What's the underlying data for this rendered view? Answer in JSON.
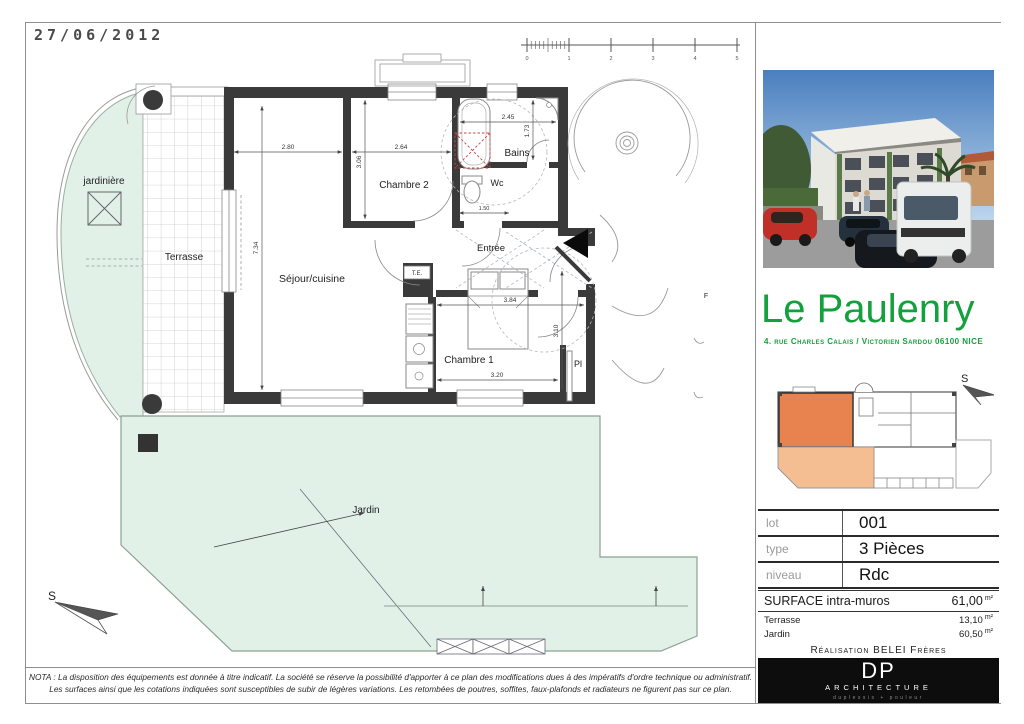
{
  "sheet": {
    "date": "27/06/2012",
    "scale_labels": [
      "0",
      "1",
      "2",
      "3",
      "4",
      "5"
    ],
    "nota_line1": "NOTA : La disposition des équipements est donnée à titre indicatif. La société se réserve la possibilité d'apporter à ce plan des modifications dues à des impératifs d'ordre technique ou administratif.",
    "nota_line2": "Les surfaces ainsi que les cotations indiquées sont susceptibles de subir de légères variations. Les retombées de poutres, soffites, faux-plafonds et radiateurs ne figurent pas sur ce plan."
  },
  "plan": {
    "labels": {
      "jardiniere": "jardinière",
      "terrasse": "Terrasse",
      "sejour": "Séjour/cuisine",
      "chambre2": "Chambre 2",
      "chambre1": "Chambre 1",
      "bains": "Bains",
      "wc": "Wc",
      "entree": "Entrée",
      "placard": "Pl",
      "jardin": "Jardin",
      "f": "F",
      "te": "T.E.",
      "compass_south": "S"
    },
    "dimensions": {
      "sejour_width": "2.80",
      "chambre2_width": "2.64",
      "chambre2_height": "3.06",
      "sejour_height": "7.34",
      "bains_width": "2.45",
      "bains_height": "1.73",
      "wc_width": "1.50",
      "chambre1_width": "3.84",
      "chambre1_height": "3.10",
      "chambre1_width_bottom": "3.20"
    }
  },
  "panel": {
    "title": "Le Paulenry",
    "address": "4. rue Charles Calais / Victorien Sardou 06100 NICE",
    "compass_south": "S",
    "info_table": {
      "rows": [
        {
          "label": "lot",
          "value": "001"
        },
        {
          "label": "type",
          "value": "3 Pièces"
        },
        {
          "label": "niveau",
          "value": "Rdc"
        }
      ]
    },
    "surfaces": {
      "main_label": "SURFACE intra-muros",
      "main_value": "61,00",
      "unit": "m²",
      "rows": [
        {
          "label": "Terrasse",
          "value": "13,10"
        },
        {
          "label": "Jardin",
          "value": "60,50"
        }
      ]
    },
    "realisation": "Réalisation BELEI Frères",
    "logo": {
      "initials": "DP",
      "name": "ARCHITECTURE",
      "tagline": "duplessis + pouleur"
    }
  },
  "colors": {
    "accent_green": "#14a03c",
    "plan_green": "#e2f1e7",
    "wall_gray": "#3a3a3a",
    "unit_orange": "#e8824e",
    "garden_orange": "#f5bd92",
    "shower_red": "#cc4444"
  }
}
